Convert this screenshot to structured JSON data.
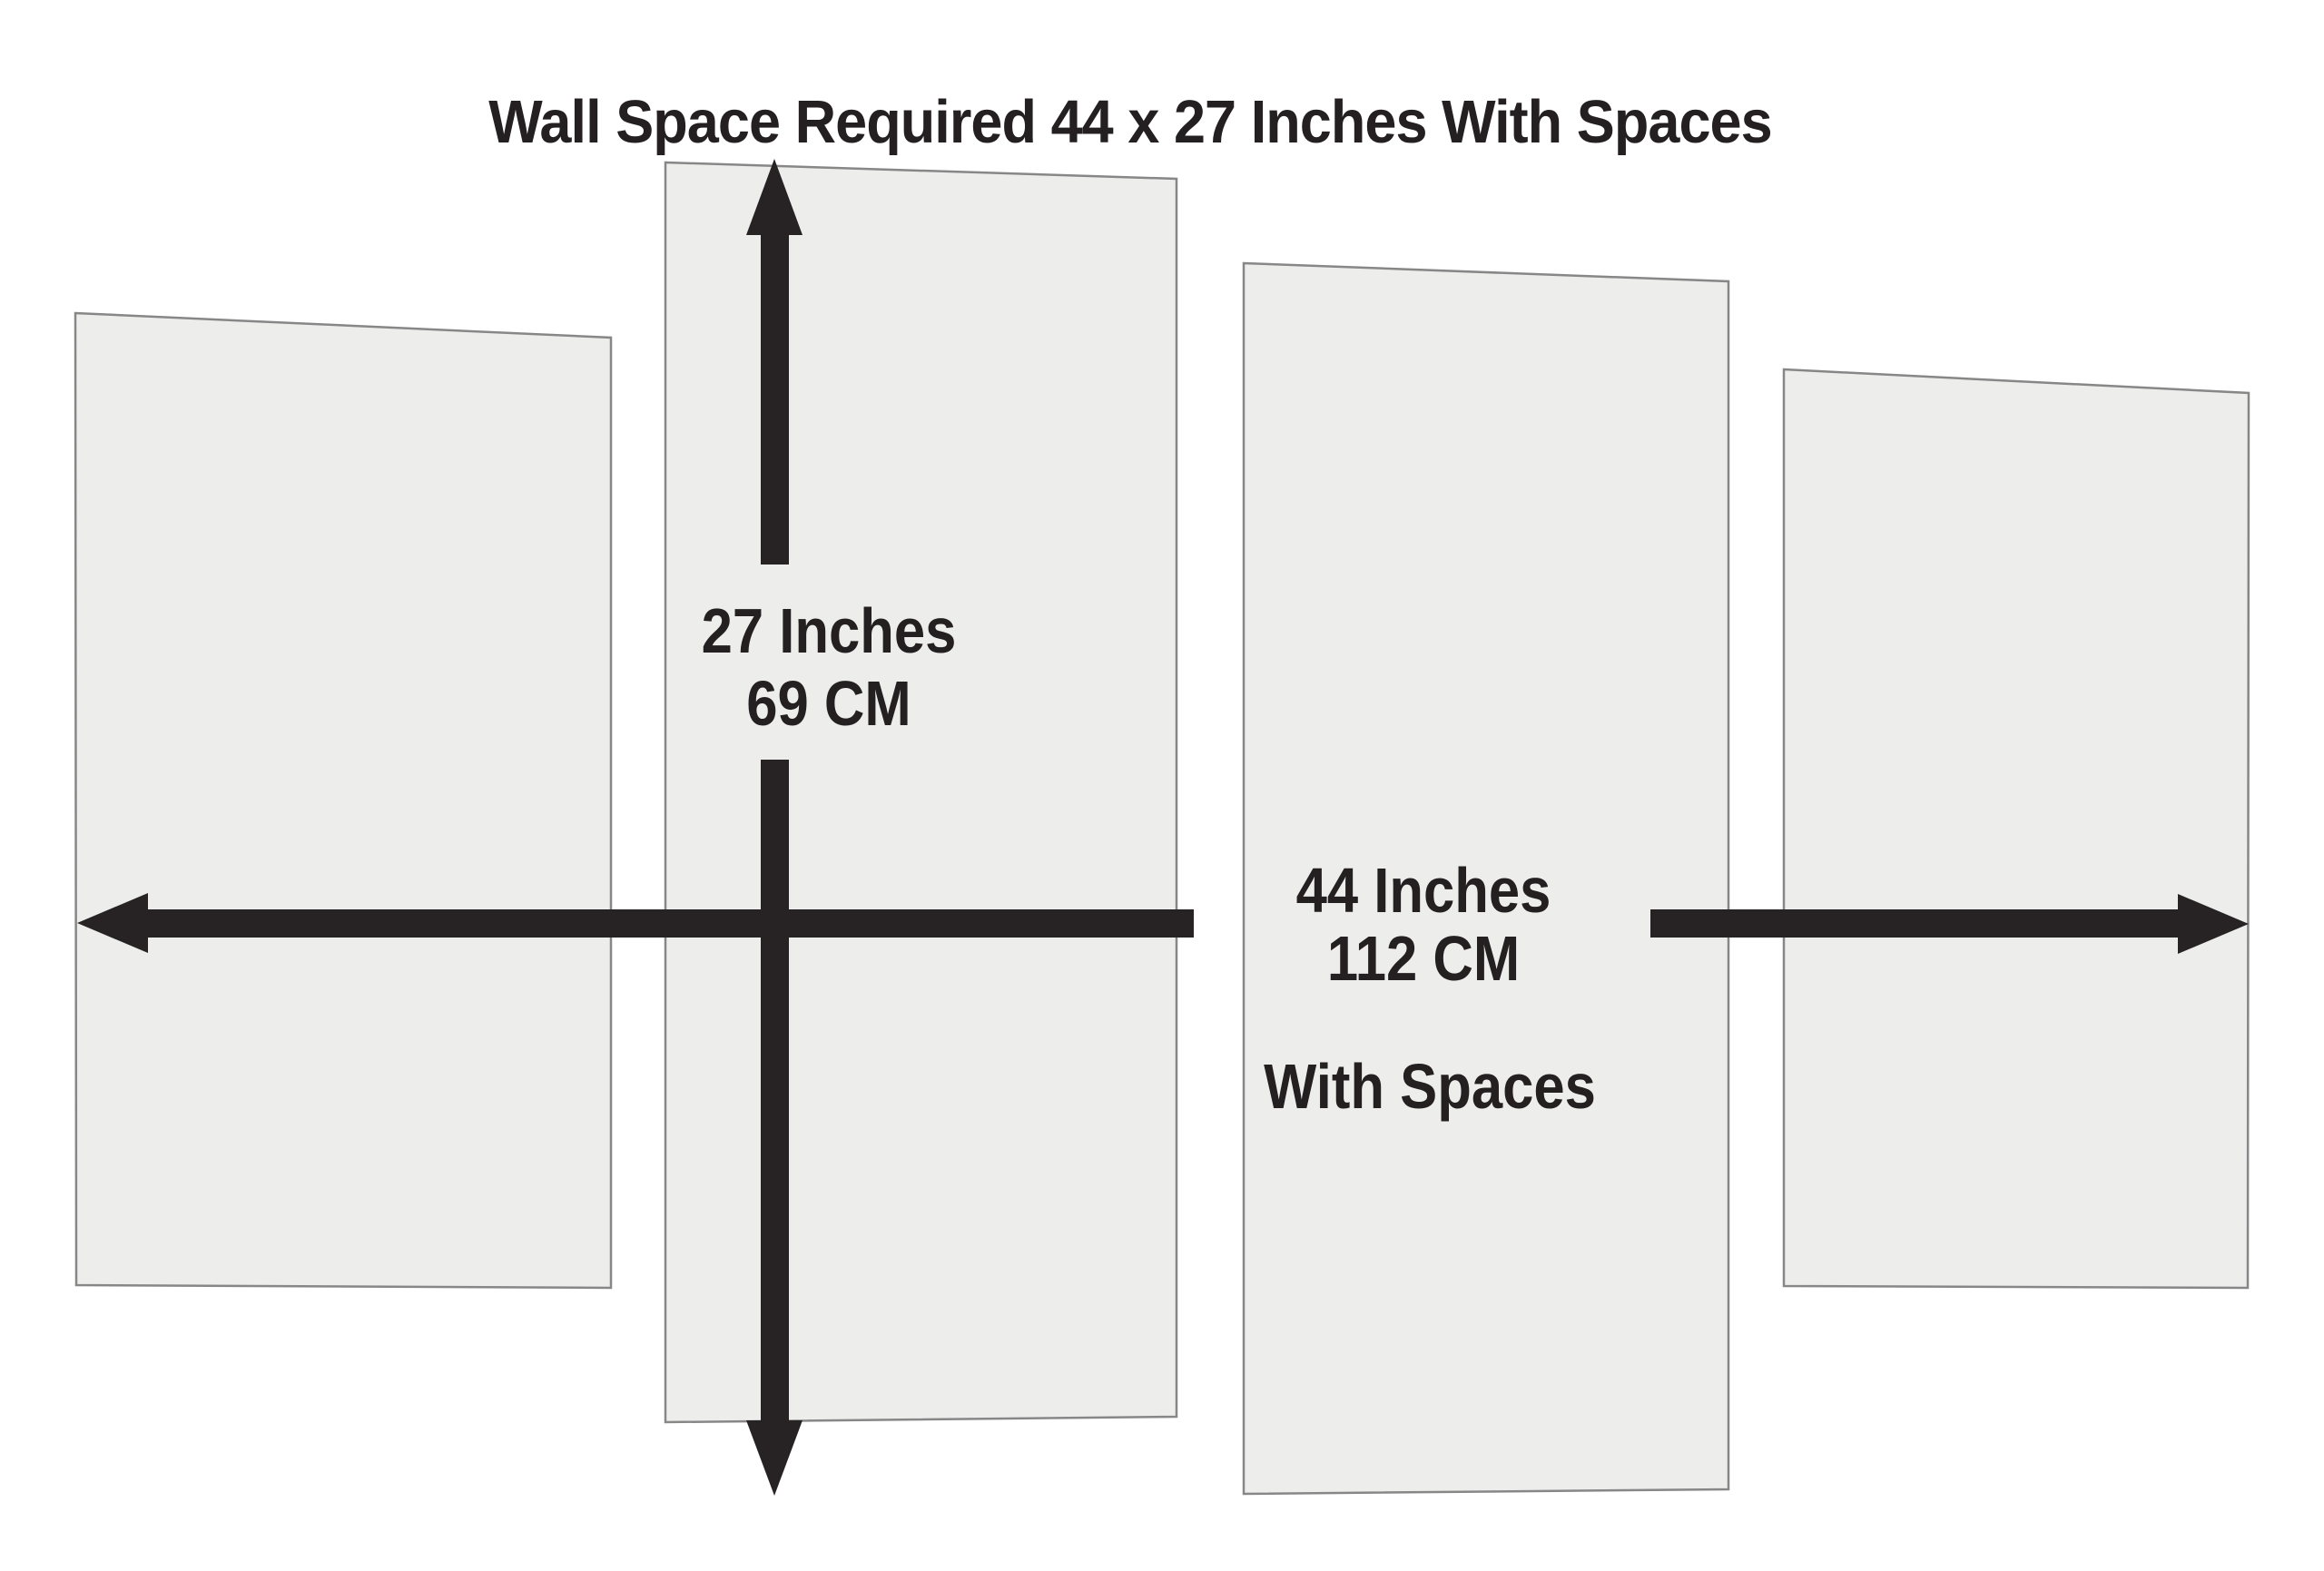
{
  "title": "Wall Space Required 44 x 27 Inches With Spaces",
  "labels": {
    "height": {
      "line1": "27 Inches",
      "line2": "69 CM"
    },
    "width": {
      "line1": "44 Inches",
      "line2": "112 CM",
      "note": "With Spaces"
    }
  },
  "panels": {
    "count": 4
  },
  "colors": {
    "background": "#ffffff",
    "panel_fill": "#ededec",
    "panel_border": "#878787",
    "arrow": "#272324",
    "text": "#242021"
  }
}
